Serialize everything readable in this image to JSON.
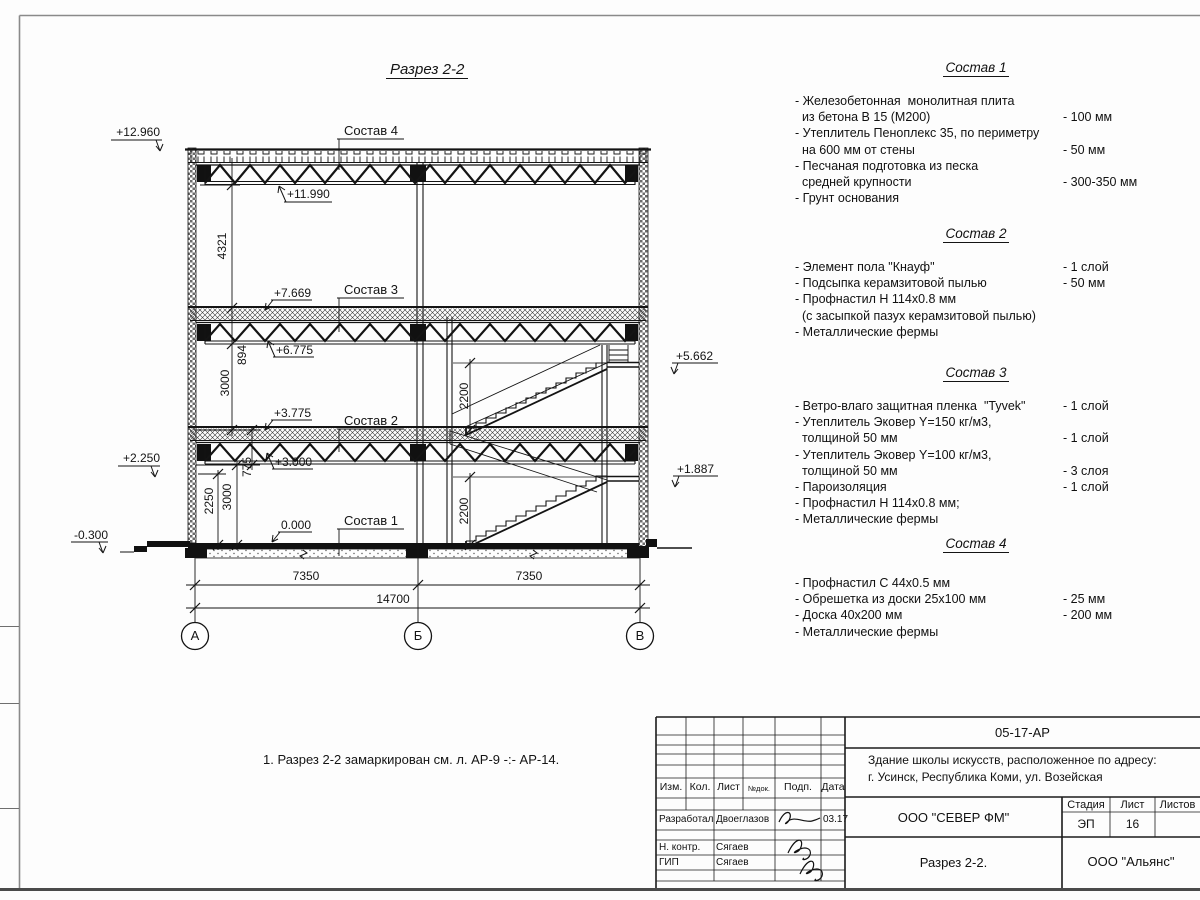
{
  "drawing": {
    "title": "Разрез 2-2",
    "note": "1. Разрез 2-2 замаркирован см. л. АР-9 -:- АР-14.",
    "levels": {
      "p12960": "+12.960",
      "p11990": "+11.990",
      "p7669": "+7.669",
      "p6775": "+6.775",
      "p3775": "+3.775",
      "p3000": "+3.000",
      "p2250": "+2.250",
      "zero": "0.000",
      "n0300": "-0.300",
      "p5662": "+5.662",
      "p1887": "+1.887"
    },
    "layer_refs": {
      "s1": "Состав 1",
      "s2": "Состав 2",
      "s3": "Состав 3",
      "s4": "Состав 4"
    },
    "dims": {
      "v4321": "4321",
      "v894": "894",
      "v3000a": "3000",
      "v2250": "2250",
      "v3000b": "3000",
      "v775": "775",
      "v2200a": "2200",
      "v2200b": "2200",
      "h7350a": "7350",
      "h7350b": "7350",
      "h14700": "14700"
    },
    "axes": {
      "a": "А",
      "b": "Б",
      "v": "В"
    }
  },
  "compositions": [
    {
      "title": "Состав 1",
      "lines": [
        {
          "t": "- Железобетонная  монолитная плита",
          "v": ""
        },
        {
          "t": "  из бетона В 15 (М200)",
          "v": "- 100 мм"
        },
        {
          "t": "- Утеплитель Пеноплекс 35, по периметру",
          "v": ""
        },
        {
          "t": "  на 600 мм от стены",
          "v": "- 50 мм"
        },
        {
          "t": "- Песчаная подготовка из песка",
          "v": ""
        },
        {
          "t": "  средней крупности",
          "v": "- 300-350 мм"
        },
        {
          "t": "- Грунт основания",
          "v": ""
        }
      ]
    },
    {
      "title": "Состав 2",
      "lines": [
        {
          "t": "- Элемент пола \"Кнауф\"",
          "v": "- 1 слой"
        },
        {
          "t": "- Подсыпка керамзитовой пылью",
          "v": "- 50 мм"
        },
        {
          "t": "- Профнастил Н 114х0.8 мм",
          "v": ""
        },
        {
          "t": "  (с засыпкой пазух керамзитовой пылью)",
          "v": ""
        },
        {
          "t": "- Металлические фермы",
          "v": ""
        }
      ]
    },
    {
      "title": "Состав 3",
      "lines": [
        {
          "t": "- Ветро-влаго защитная пленка  \"Tyvek\"",
          "v": "- 1 слой"
        },
        {
          "t": "- Утеплитель Эковер Y=150 кг/м3,",
          "v": ""
        },
        {
          "t": "  толщиной 50 мм",
          "v": "- 1 слой"
        },
        {
          "t": "- Утеплитель Эковер Y=100 кг/м3,",
          "v": ""
        },
        {
          "t": "  толщиной 50 мм",
          "v": "- 3 слоя"
        },
        {
          "t": "- Пароизоляция",
          "v": "- 1 слой"
        },
        {
          "t": "- Профнастил Н 114х0.8 мм;",
          "v": ""
        },
        {
          "t": "- Металлические фермы",
          "v": ""
        }
      ]
    },
    {
      "title": "Состав 4",
      "lines": [
        {
          "t": "- Профнастил С 44х0.5 мм",
          "v": ""
        },
        {
          "t": "- Обрешетка из доски 25х100 мм",
          "v": "- 25 мм"
        },
        {
          "t": "- Доска 40х200 мм",
          "v": "- 200 мм"
        },
        {
          "t": "- Металлические фермы",
          "v": ""
        }
      ]
    }
  ],
  "titleblock": {
    "doc_code": "05-17-АР",
    "project_line1": "Здание школы искусств, расположенное по адресу:",
    "project_line2": "г. Усинск, Республика Коми, ул. Возейская",
    "cols": [
      "Изм.",
      "Кол.",
      "Лист",
      "№док.",
      "Подп.",
      "Дата"
    ],
    "rows": [
      {
        "role": "Разработал",
        "name": "Двоеглазов",
        "date": "03.17"
      },
      {
        "role": "Н. контр.",
        "name": "Сягаев",
        "date": ""
      },
      {
        "role": "ГИП",
        "name": "Сягаев",
        "date": ""
      }
    ],
    "stage_label": "Стадия",
    "sheet_label": "Лист",
    "sheets_label": "Листов",
    "stage_value": "ЭП",
    "sheet_value": "16",
    "sheets_value": "",
    "org1": "ООО \"СЕВЕР ФМ\"",
    "drawing_name": "Разрез 2-2.",
    "org2": "ООО \"Альянс\""
  }
}
